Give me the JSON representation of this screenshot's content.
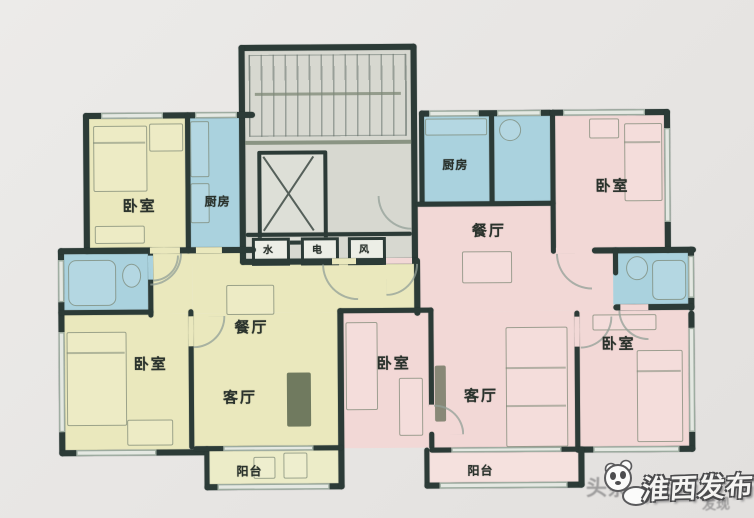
{
  "title": "三梯户型平面图",
  "colors": {
    "bg": "#e8e6e4",
    "wall": "#2c3b37",
    "ink": "#2a322c",
    "unit_a": "#eae8bd",
    "balcony_a": "#ececc8",
    "unit_b": "#f2d8d6",
    "balcony_b": "#f5e1de",
    "wet": "#aad2de",
    "core_bg": "#d7d8d0",
    "sketch": "#7d8876",
    "win_line": "#9cab9f",
    "tv_dark": "#5b664f",
    "watermark_front": "#f5f4f2",
    "watermark_outline": "#4a4a4c",
    "watermark_back": "rgba(108,108,110,0.58)"
  },
  "rooms": {
    "left_bedroom_top": "卧室",
    "left_kitchen": "厨房",
    "left_bedroom_main": "卧室",
    "left_dining": "餐厅",
    "left_living": "客厅",
    "left_balcony": "阳台",
    "right_kitchen": "厨房",
    "right_dining": "餐厅",
    "right_bedroom_top": "卧室",
    "right_bedroom_mid": "卧室",
    "right_living": "客厅",
    "right_bedroom_bottom": "卧室",
    "right_balcony": "阳台"
  },
  "core": {
    "water": "水",
    "electric": "电",
    "vent": "风"
  },
  "watermark": {
    "back_text": "头条",
    "front_text": "淮西发布",
    "back_text2": "发现"
  }
}
